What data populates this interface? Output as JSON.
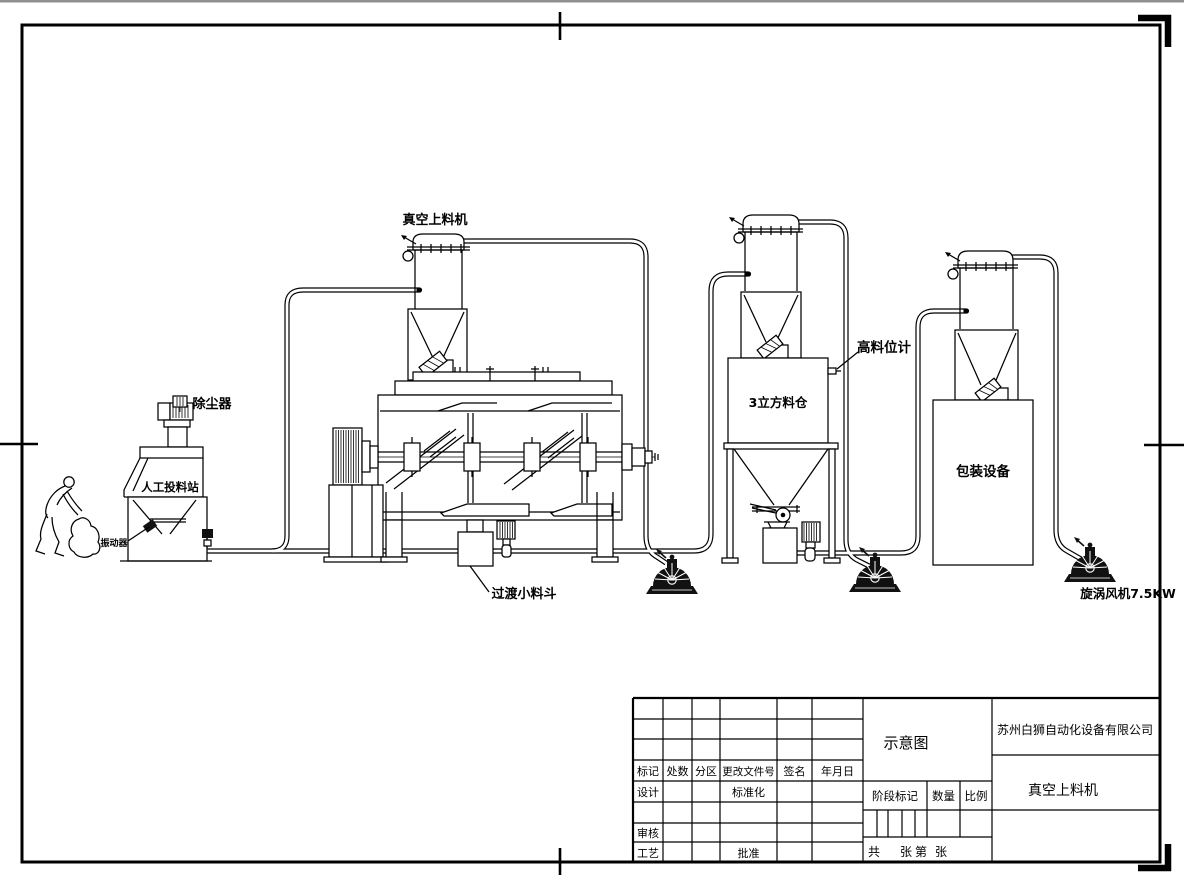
{
  "drawing": {
    "sheet": {
      "background": "#ffffff",
      "line_color": "#000000",
      "top_strip_color": "#909090"
    },
    "labels": {
      "dust_collector": "除尘器",
      "manual_feed_station": "人工投料站",
      "vibrator": "振动器",
      "vacuum_feeder": "真空上料机",
      "transition_hopper": "过渡小料斗",
      "silo": "3立方料仓",
      "high_level_gauge": "高料位计",
      "packaging_equipment": "包装设备",
      "vortex_blower": "旋涡风机7.5KW"
    },
    "title_block": {
      "header": [
        "标记",
        "处数",
        "分区",
        "更改文件号",
        "签名",
        "年月日"
      ],
      "design": "设计",
      "standardization": "标准化",
      "review": "审核",
      "process": "工艺",
      "approval": "批准",
      "drawing_type": "示意图",
      "company": "苏州白狮自动化设备有限公司",
      "product_name": "真空上料机",
      "stage_mark": "阶段标记",
      "quantity": "数量",
      "scale": "比例",
      "total_label": "共",
      "sheets_label": "张",
      "page_label": "第",
      "page_unit_label": "张"
    }
  }
}
